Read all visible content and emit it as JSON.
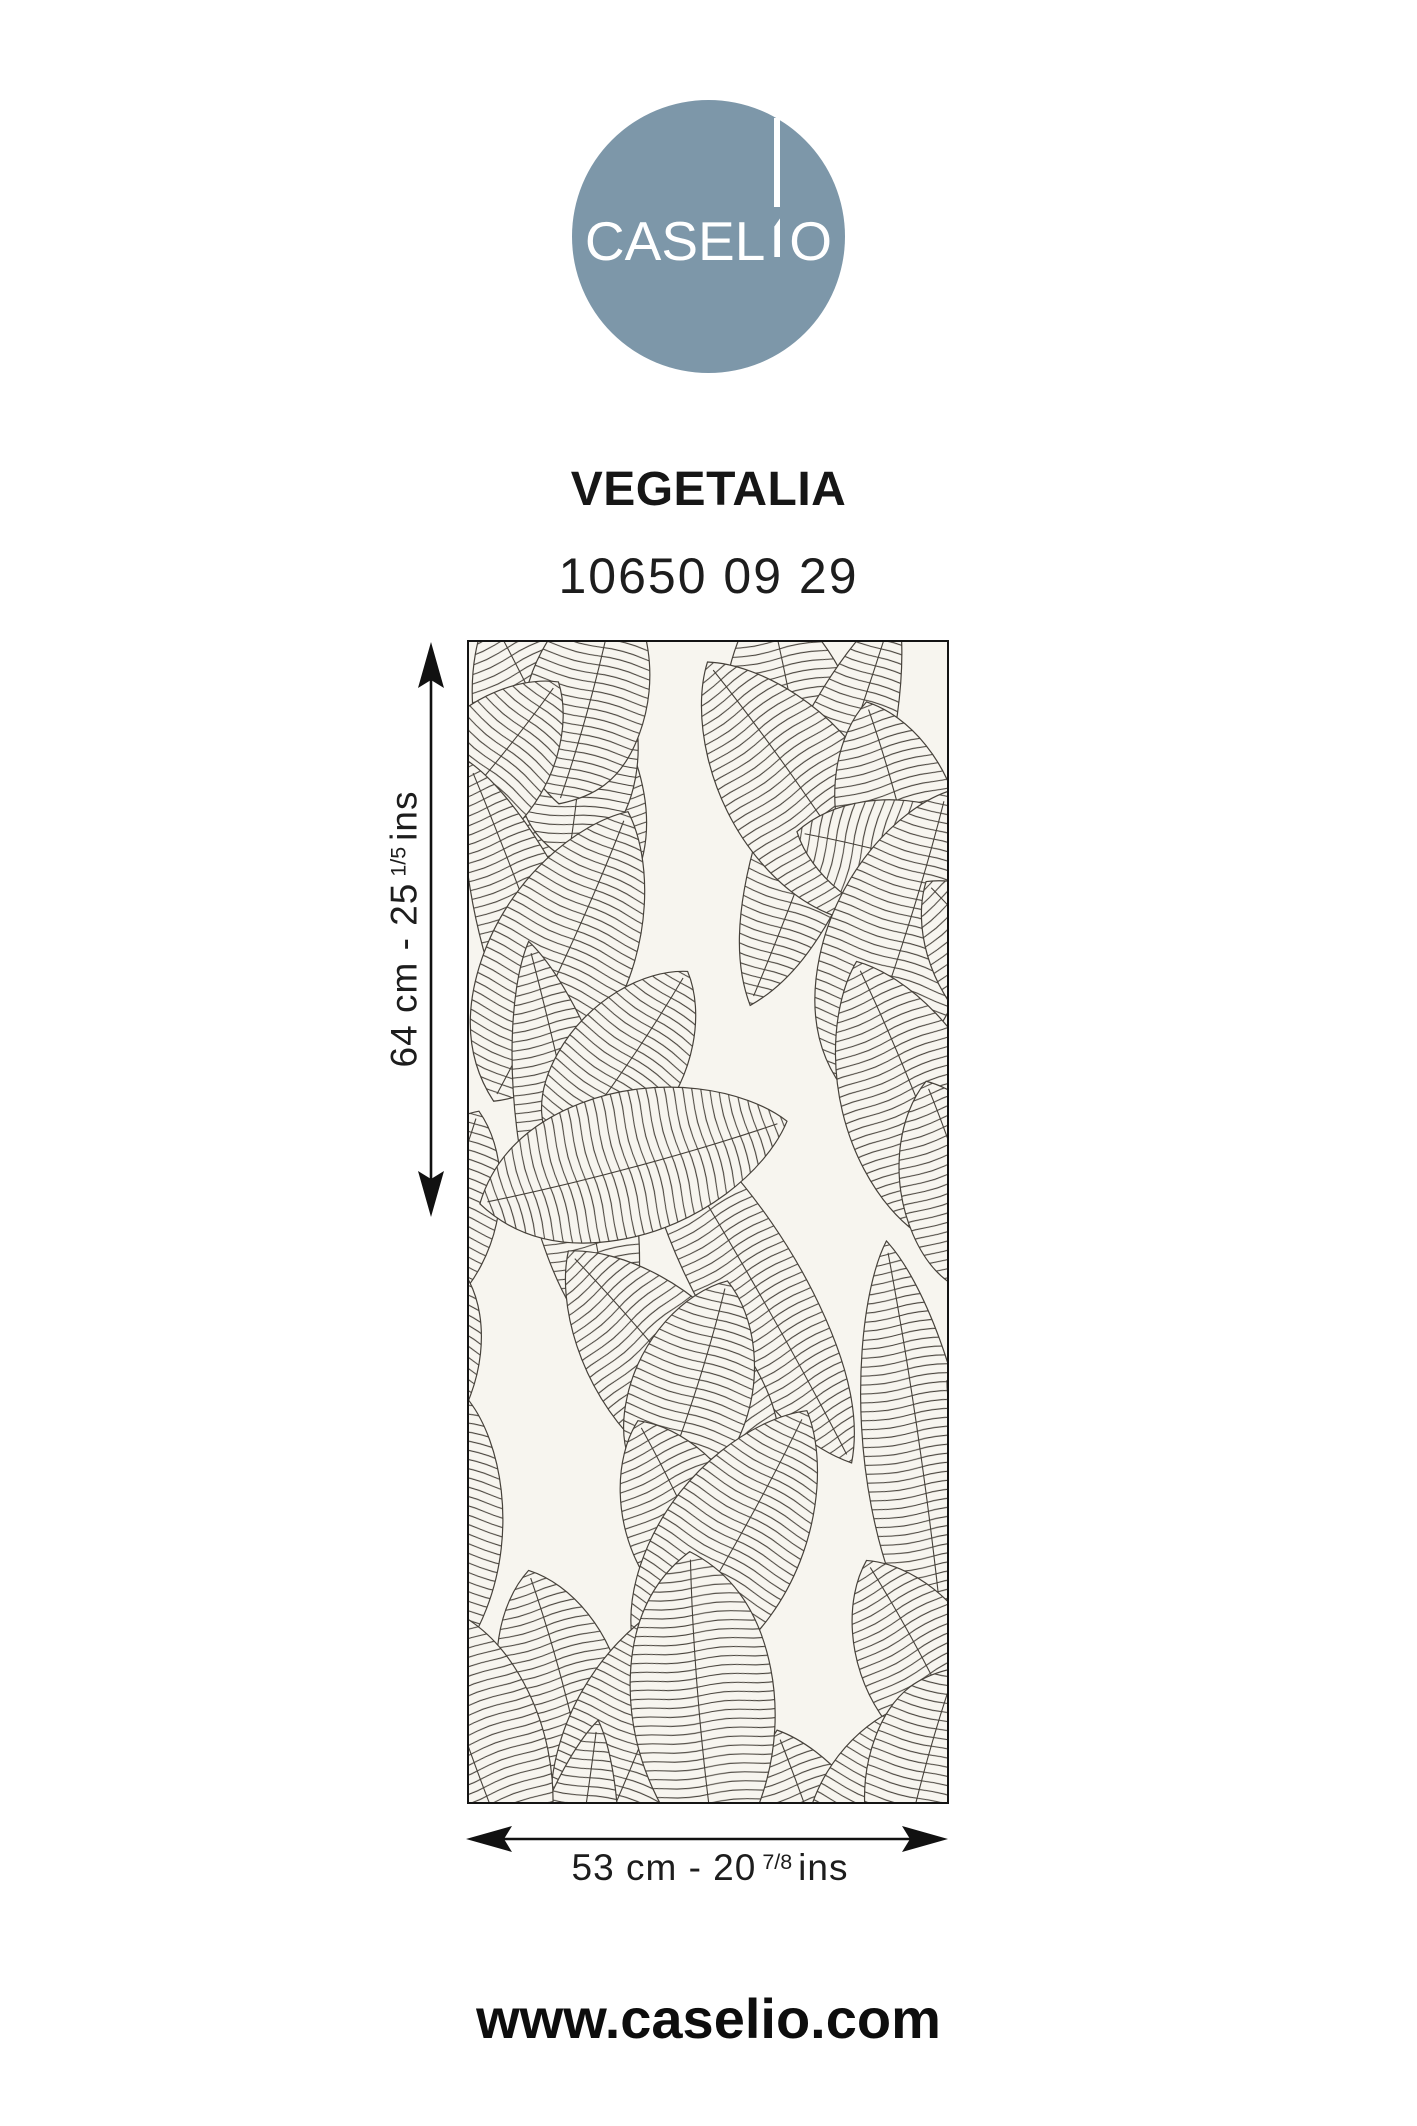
{
  "brand": {
    "name": "CASELIO",
    "name_parts": {
      "pre": "CASEL",
      "post": "O"
    },
    "circle_color": "#7d97a9",
    "wordmark_color": "#ffffff"
  },
  "product": {
    "collection": "VEGETALIA",
    "reference": "10650 09 29"
  },
  "swatch": {
    "description": "leaf line-art wallpaper swatch",
    "background_color": "#f7f5ef",
    "line_color": "#46413a"
  },
  "dimensions": {
    "height": {
      "prefix": "64 cm - 25",
      "sup": "1/5",
      "suffix": "ins"
    },
    "width": {
      "prefix": "53 cm - 20",
      "sup": "7/8",
      "suffix": "ins"
    }
  },
  "footer": {
    "website": "www.caselio.com"
  }
}
